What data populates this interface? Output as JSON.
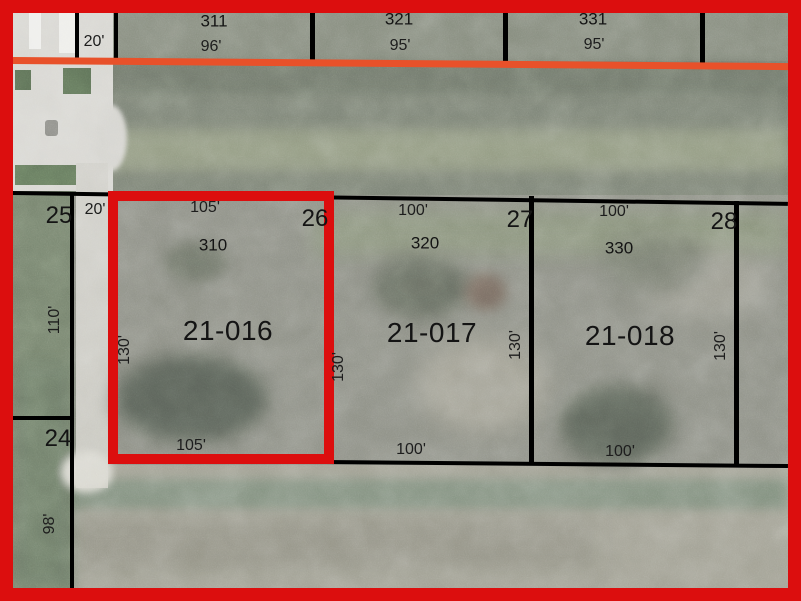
{
  "title": "Parcel plat overlay on aerial photo",
  "colors": {
    "highlight_red": "#dc0e0e",
    "road_centerline_orange": "#e8512a",
    "boundary_black": "#000000"
  },
  "north_lots": {
    "corner_width": "20'",
    "lots": [
      {
        "address": "311",
        "frontage": "96'"
      },
      {
        "address": "321",
        "frontage": "95'"
      },
      {
        "address": "331",
        "frontage": "95'"
      }
    ]
  },
  "west_lots": [
    {
      "number": "25",
      "strip_width": "20'",
      "depth": "110'"
    },
    {
      "number": "24",
      "depth": "98'"
    }
  ],
  "parcels": [
    {
      "id": "21-016",
      "lot_number": "26",
      "address": "310",
      "front_width": "105'",
      "rear_width": "105'",
      "depth_west": "130'",
      "depth_east": "130'",
      "highlighted": true
    },
    {
      "id": "21-017",
      "lot_number": "27",
      "address": "320",
      "front_width": "100'",
      "rear_width": "100'",
      "depth_east": "130'",
      "highlighted": false
    },
    {
      "id": "21-018",
      "lot_number": "28",
      "address": "330",
      "front_width": "100'",
      "rear_width": "100'",
      "depth_east": "130'",
      "highlighted": false
    }
  ]
}
